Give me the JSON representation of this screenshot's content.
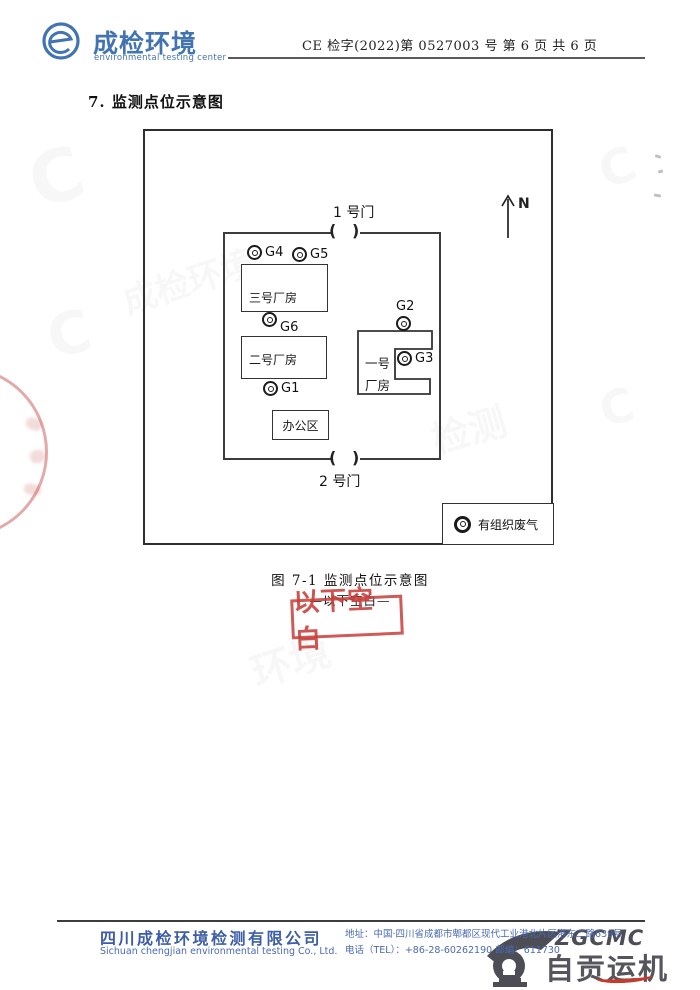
{
  "header": {
    "logo_title": "成检环境",
    "logo_subtitle": "environmental testing center",
    "doc_number": "CE 检字(2022)第 0527003 号 第 6 页 共 6 页"
  },
  "section_title": "7. 监测点位示意图",
  "diagram": {
    "north": "N",
    "gate1": "1 号门",
    "gate2": "2 号门",
    "paren_l": "(",
    "paren_r": ")",
    "building3": "三号厂房",
    "building2": "二号厂房",
    "building1_line1": "一号",
    "building1_line2": "厂房",
    "office": "办公区",
    "points": {
      "g1": "G1",
      "g2": "G2",
      "g3": "G3",
      "g4": "G4",
      "g5": "G5",
      "g6": "G6"
    },
    "legend": "有组织废气"
  },
  "caption": "图 7-1 监测点位示意图",
  "blank_note": "—以下空白—",
  "stamp_text": "以下空白",
  "footer": {
    "company_cn": "四川成检环境检测有限公司",
    "company_en": "Sichuan chengjian environmental testing Co., Ltd.",
    "address": "地址：中国·四川省成都市郫都区现代工业港北片区港东二路639号",
    "phone": "电话（TEL）：+86-28-60262190  邮编：611730"
  },
  "brand_watermark": {
    "latin": "ZGCMC",
    "cn": "自贡运机"
  },
  "colors": {
    "header_blue": "#4374b2",
    "footer_blue": "#4a6ab2",
    "stamp_red": "#c73e3a"
  }
}
